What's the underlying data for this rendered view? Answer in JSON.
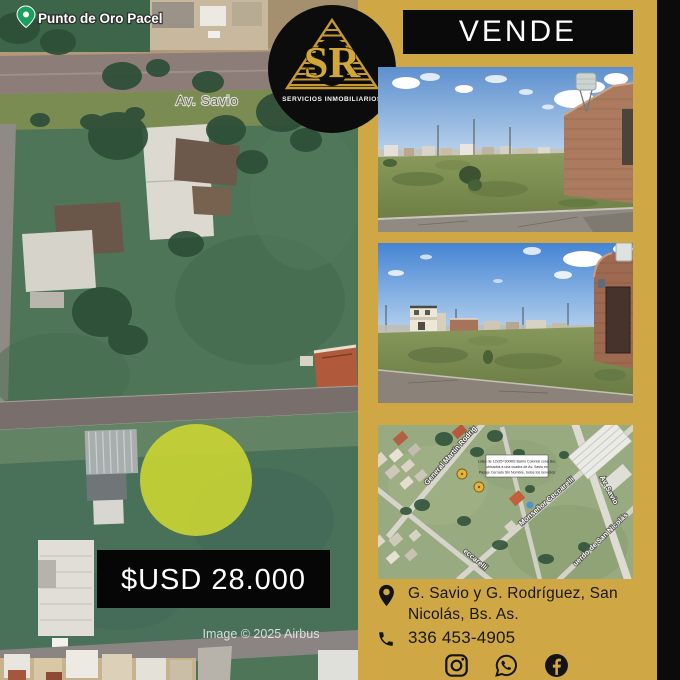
{
  "colors": {
    "background_gold": "#cfa845",
    "panel_black": "#0b0b0b",
    "logo_gold": "#d2a73a",
    "highlight_circle": "#c8d234",
    "price_bg": "#060606",
    "text_dark": "#171717",
    "text_white": "#ffffff"
  },
  "banner": {
    "label": "VENDE"
  },
  "logo": {
    "monogram": "SR",
    "subtitle": "SERVICIOS INMOBILIARIOS"
  },
  "main_map": {
    "pin_label": "Punto de Oro Pacel",
    "street_label": "Av. Savio",
    "price": "$USD 28.000",
    "credit": "Image © 2025 Airbus"
  },
  "minimap": {
    "streets": [
      "General Martín Rodríg",
      "Monseñor Ceccarelli",
      "Av. Savio",
      "uerdo de San Nicolás",
      "eccarelli"
    ],
    "info_box": [
      "Lotes de 12x25=300M2 Barrio Colonial zona Sur,",
      "ubicados a una cuadra de Av. Savio en",
      "Pasaje Cerrado Sin Nombre, todos los servicios"
    ]
  },
  "contact": {
    "address_line1": "G. Savio y G. Rodríguez, San",
    "address_line2": "Nicolás, Bs. As.",
    "phone": "336 453-4905"
  },
  "social": {
    "icons": [
      "instagram-icon",
      "whatsapp-icon",
      "facebook-icon"
    ]
  }
}
